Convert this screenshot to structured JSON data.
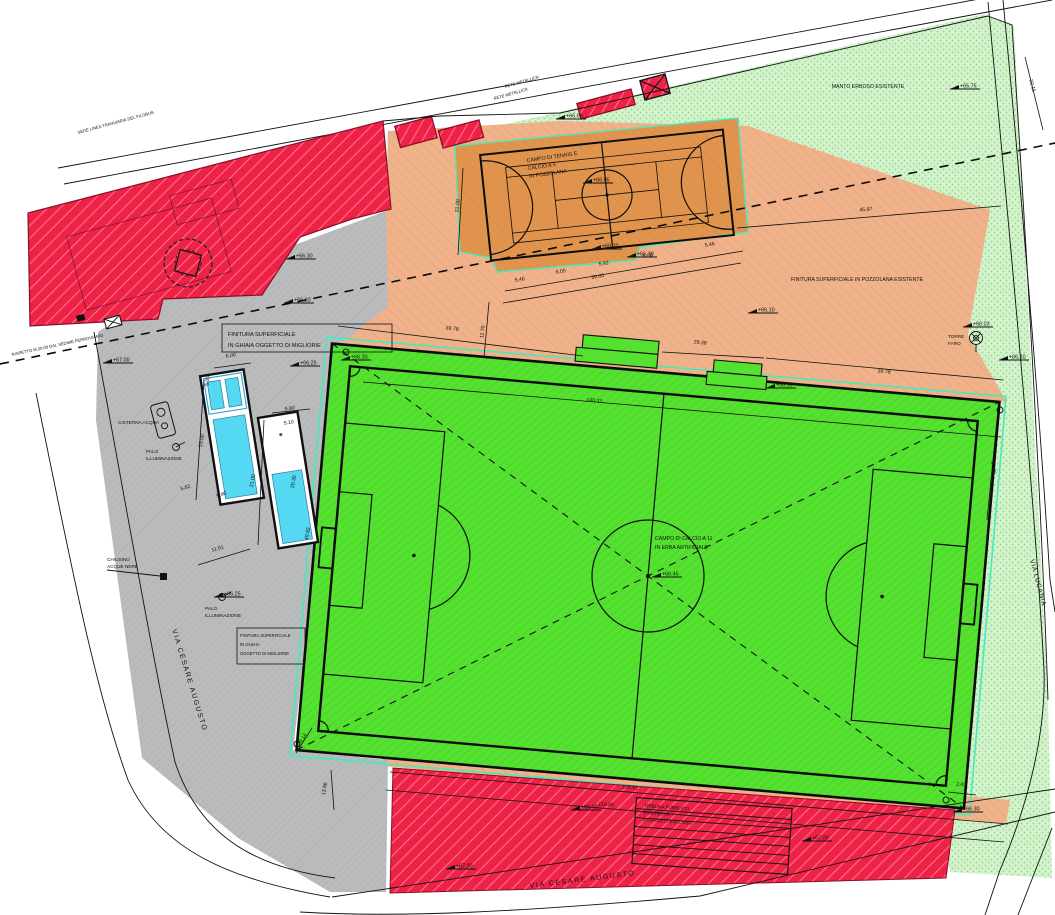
{
  "zones": {
    "manto_erboso_label": "MANTO ERBOSO ESISTENTE",
    "pozzolana_label": "FINITURA SUPERFICIALE IN POZZOLANA ESISTENTE",
    "court_line1": "CAMPO DI TENNIS E",
    "court_line2": "CALCIO A 5",
    "court_line3": "IN POZZOLANA",
    "campo11_line1": "CAMPO DI CALCIO A 11",
    "campo11_line2": "IN ERBA ARTIFICIALE",
    "ghiaia_box1_line1": "FINITURA SUPERFICIALE",
    "ghiaia_box1_line2": "IN GHIAIA OGGETTO DI MIGLIORIE",
    "ghiaia_box2_line1": "FINITURA SUPERFICIALE",
    "ghiaia_box2_line2": "IN GHIAIA",
    "ghiaia_box2_line3": "OGGETTO DI MIGLIORIE",
    "tribuna_line1": "TRIBUNA PUBBLICO",
    "tribuna_line2": "ESISTENTE",
    "tribuna_line3": "INTERDETTA ALL'USO"
  },
  "streets": {
    "left": "VIA CESARE AUGUSTO",
    "bottom": "VIA CESARE AUGUSTO",
    "right": "VIA LUCANIA"
  },
  "labels": {
    "torre_faro_1": "TORRE",
    "torre_faro_2": "FARO",
    "cisterna": "CISTERNA ACQUA",
    "palo1_1": "PALO",
    "palo1_2": "ILLUMINAZIONE",
    "palo2_1": "PALO",
    "palo2_2": "ILLUMINAZIONE",
    "chiusino_1": "CHIUSINO",
    "chiusino_2": "ACQUE NERE",
    "rete1": "RETE METALLICA",
    "rete2": "RETE METALLICA",
    "binario": "SEDE LINEA TRANVIARIA DEL FILOBUS",
    "setback": "RISPETTO M.30.00 DAL SEDIME FERROVIARIO"
  },
  "colors": {
    "red": "#ee2147",
    "red_stripe": "#ff6b84",
    "orange": "#efb28a",
    "court_orange": "#e0944d",
    "field_green": "#55e130",
    "light_green": "#d4f2cc",
    "gray": "#b9bbbd",
    "cyan": "#55d8f2",
    "mint": "#45ecb9"
  },
  "dimensions": [
    {
      "v": "39.78",
      "x": 452,
      "y": 330,
      "r": 7
    },
    {
      "v": "11.70",
      "x": 484,
      "y": 332,
      "r": -83
    },
    {
      "v": "29.38",
      "x": 700,
      "y": 344,
      "r": 6
    },
    {
      "v": "39.78",
      "x": 884,
      "y": 373,
      "r": 6
    },
    {
      "v": "140.33",
      "x": 594,
      "y": 402,
      "r": 6
    },
    {
      "v": "45.97",
      "x": 866,
      "y": 211,
      "r": -5
    },
    {
      "v": "32.11",
      "x": 1031,
      "y": 86,
      "r": 74
    },
    {
      "v": "21.00",
      "x": 459,
      "y": 206,
      "r": -84
    },
    {
      "v": "5.46",
      "x": 520,
      "y": 281,
      "r": -10
    },
    {
      "v": "6.05",
      "x": 561,
      "y": 273,
      "r": -10
    },
    {
      "v": "5.92",
      "x": 604,
      "y": 265,
      "r": -10
    },
    {
      "v": "6.08",
      "x": 648,
      "y": 257,
      "r": -10
    },
    {
      "v": "5.46",
      "x": 710,
      "y": 246,
      "r": -10
    },
    {
      "v": "39.00",
      "x": 598,
      "y": 278,
      "r": -10
    },
    {
      "v": "6.00",
      "x": 231,
      "y": 357,
      "r": -9
    },
    {
      "v": "5.00",
      "x": 209,
      "y": 381,
      "r": -84
    },
    {
      "v": "15.50",
      "x": 203,
      "y": 441,
      "r": -80
    },
    {
      "v": "5.82",
      "x": 186,
      "y": 489,
      "r": -18
    },
    {
      "v": "5.40",
      "x": 222,
      "y": 496,
      "r": -18
    },
    {
      "v": "5.80",
      "x": 290,
      "y": 410,
      "r": -9
    },
    {
      "v": "5.10",
      "x": 289,
      "y": 424,
      "r": -9
    },
    {
      "v": "21.00",
      "x": 254,
      "y": 481,
      "r": -80
    },
    {
      "v": "20.30",
      "x": 295,
      "y": 482,
      "r": -80
    },
    {
      "v": "49.82",
      "x": 309,
      "y": 534,
      "r": -80
    },
    {
      "v": "11.61",
      "x": 218,
      "y": 550,
      "r": -16
    },
    {
      "v": "9.14",
      "x": 304,
      "y": 739,
      "r": -55
    },
    {
      "v": "13.86",
      "x": 326,
      "y": 789,
      "r": -80
    },
    {
      "v": "106.92",
      "x": 630,
      "y": 789,
      "r": 5
    },
    {
      "v": "119.85",
      "x": 606,
      "y": 806,
      "r": 5
    },
    {
      "v": "2.43",
      "x": 961,
      "y": 786,
      "r": 5
    },
    {
      "v": "60.30",
      "x": 992,
      "y": 468,
      "r": 82
    }
  ],
  "elevations": [
    {
      "v": "+66.05",
      "x": 583,
      "y": 183
    },
    {
      "v": "+66.20",
      "x": 592,
      "y": 249
    },
    {
      "v": "+66.10",
      "x": 627,
      "y": 257
    },
    {
      "v": "+66.10",
      "x": 748,
      "y": 313
    },
    {
      "v": "+65.75",
      "x": 950,
      "y": 89
    },
    {
      "v": "+66.03",
      "x": 963,
      "y": 327
    },
    {
      "v": "+66.10",
      "x": 999,
      "y": 360
    },
    {
      "v": "+66.30",
      "x": 286,
      "y": 259
    },
    {
      "v": "+66.20",
      "x": 284,
      "y": 303
    },
    {
      "v": "+67.00",
      "x": 103,
      "y": 363
    },
    {
      "v": "+66.25",
      "x": 290,
      "y": 366
    },
    {
      "v": "+66.25",
      "x": 214,
      "y": 597
    },
    {
      "v": "+66.45",
      "x": 652,
      "y": 577
    },
    {
      "v": "+66.00",
      "x": 571,
      "y": 810
    },
    {
      "v": "+67.00",
      "x": 802,
      "y": 841
    },
    {
      "v": "+67.00",
      "x": 446,
      "y": 869
    },
    {
      "v": "+66.00",
      "x": 556,
      "y": 119
    },
    {
      "v": "+66.30",
      "x": 953,
      "y": 812
    },
    {
      "v": "+66.30",
      "x": 341,
      "y": 360
    },
    {
      "v": "+66.30",
      "x": 766,
      "y": 388
    }
  ]
}
